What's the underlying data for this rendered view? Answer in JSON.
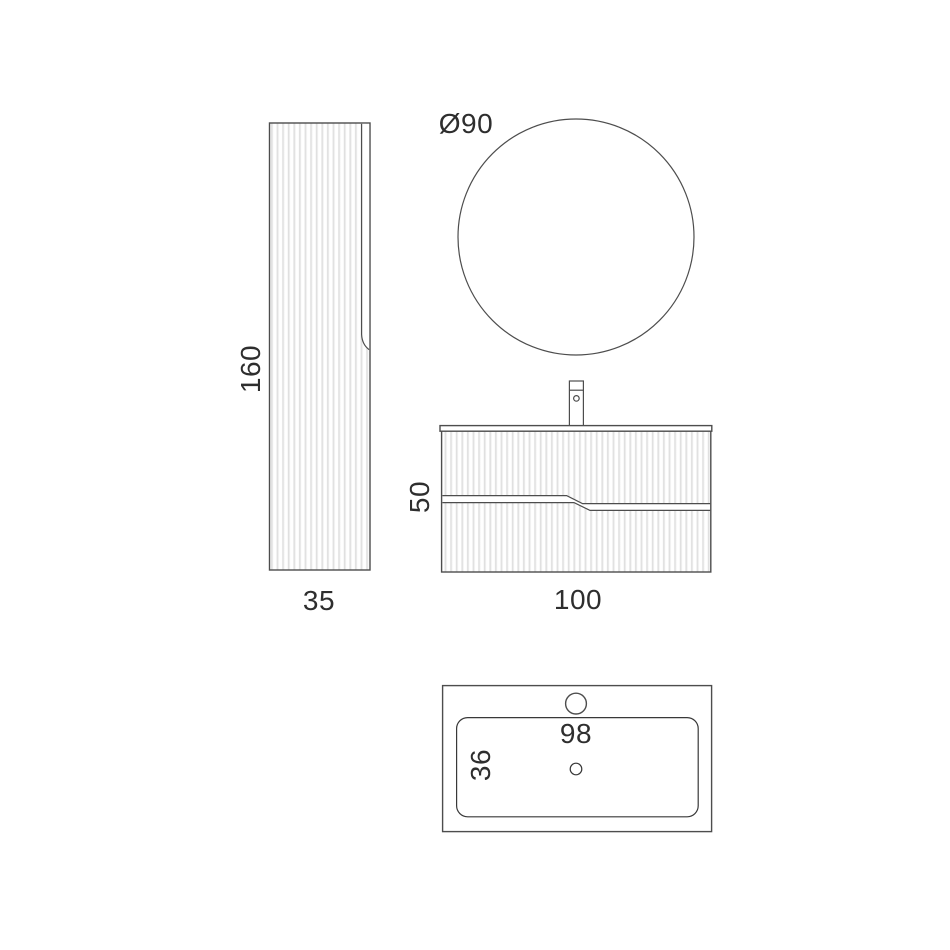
{
  "diagram": {
    "colors": {
      "background": "#ffffff",
      "line": "#4d4d4d",
      "line_dark": "#383838",
      "flute": "#d9d9d9",
      "flute_light": "#ebebeb",
      "text": "#2e2e2e"
    },
    "views": {
      "tall_cabinet": {
        "height_label": "160",
        "width_label": "35"
      },
      "mirror": {
        "diameter_label": "Ø90"
      },
      "vanity": {
        "height_label": "50",
        "width_label": "100"
      },
      "basin_top": {
        "width_label": "98",
        "depth_label": "36"
      }
    }
  }
}
